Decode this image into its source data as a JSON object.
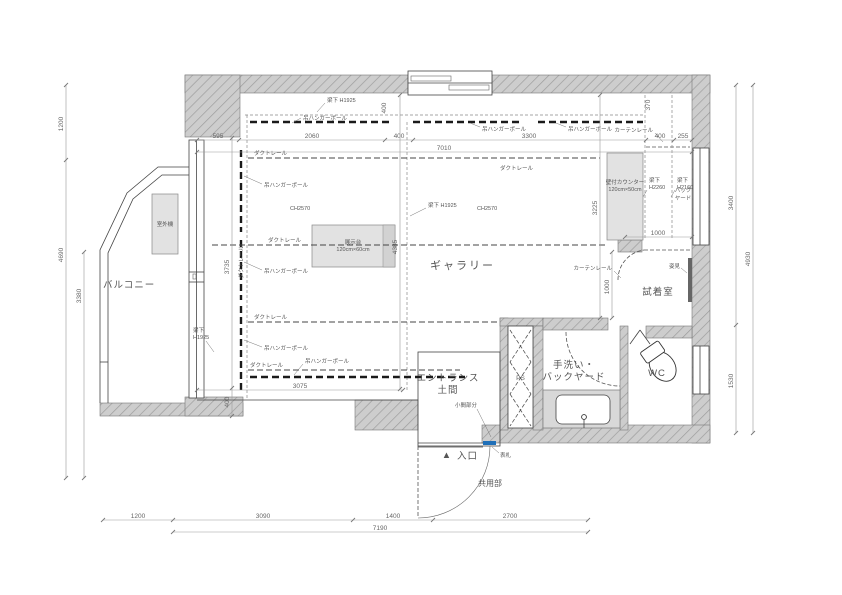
{
  "rooms": {
    "gallery": "ギャラリー",
    "balcony": "バルコニー",
    "entrance_l1": "エントランス",
    "entrance_l2": "土間",
    "fitting_room": "試着室",
    "wc": "WC",
    "wash_l1": "手洗い・",
    "wash_l2": "バックヤード",
    "common_area": "共用部",
    "entry": "入口",
    "entry_marker": "▲"
  },
  "fixtures": {
    "outdoor_unit": "室外機",
    "display_table_l1": "展示台",
    "display_table_l2": "120cm×60cm",
    "wall_counter_l1": "壁付カウンター",
    "wall_counter_l2": "120cm×50cm",
    "backyard_l1": "バック",
    "backyard_l2": "ヤード",
    "pipe_space": "PS",
    "mirror": "姿見",
    "nameplate": "表札",
    "booth_note": "小間部分"
  },
  "annotations": {
    "duct_rail": "ダクトレール",
    "hanger_pole": "吊ハンガーポール",
    "curtain_rail": "カーテンレール",
    "beam_h1925": "梁下 H1925",
    "beam": "梁下",
    "h1925": "H1925",
    "h2260": "H2260",
    "h2160": "H2160",
    "ceiling_height": "CH2570"
  },
  "dims": {
    "top": [
      "595",
      "2060",
      "400",
      "3300",
      "400",
      "255"
    ],
    "top_total": "7010",
    "offset_400": "400",
    "niche_370": "370",
    "left": [
      "1200",
      "4690",
      "3380"
    ],
    "right": [
      "3400",
      "4930",
      "1530"
    ],
    "bottom": [
      "1200",
      "3090",
      "1400",
      "2700"
    ],
    "bottom_total": "7190",
    "gallery_width": "3075",
    "gallery_left": "3735",
    "gallery_left_sub": "400",
    "gallery_depth": "4385",
    "counter_depth": "3225",
    "fitting_w": "1000",
    "fitting_d": "1000"
  }
}
